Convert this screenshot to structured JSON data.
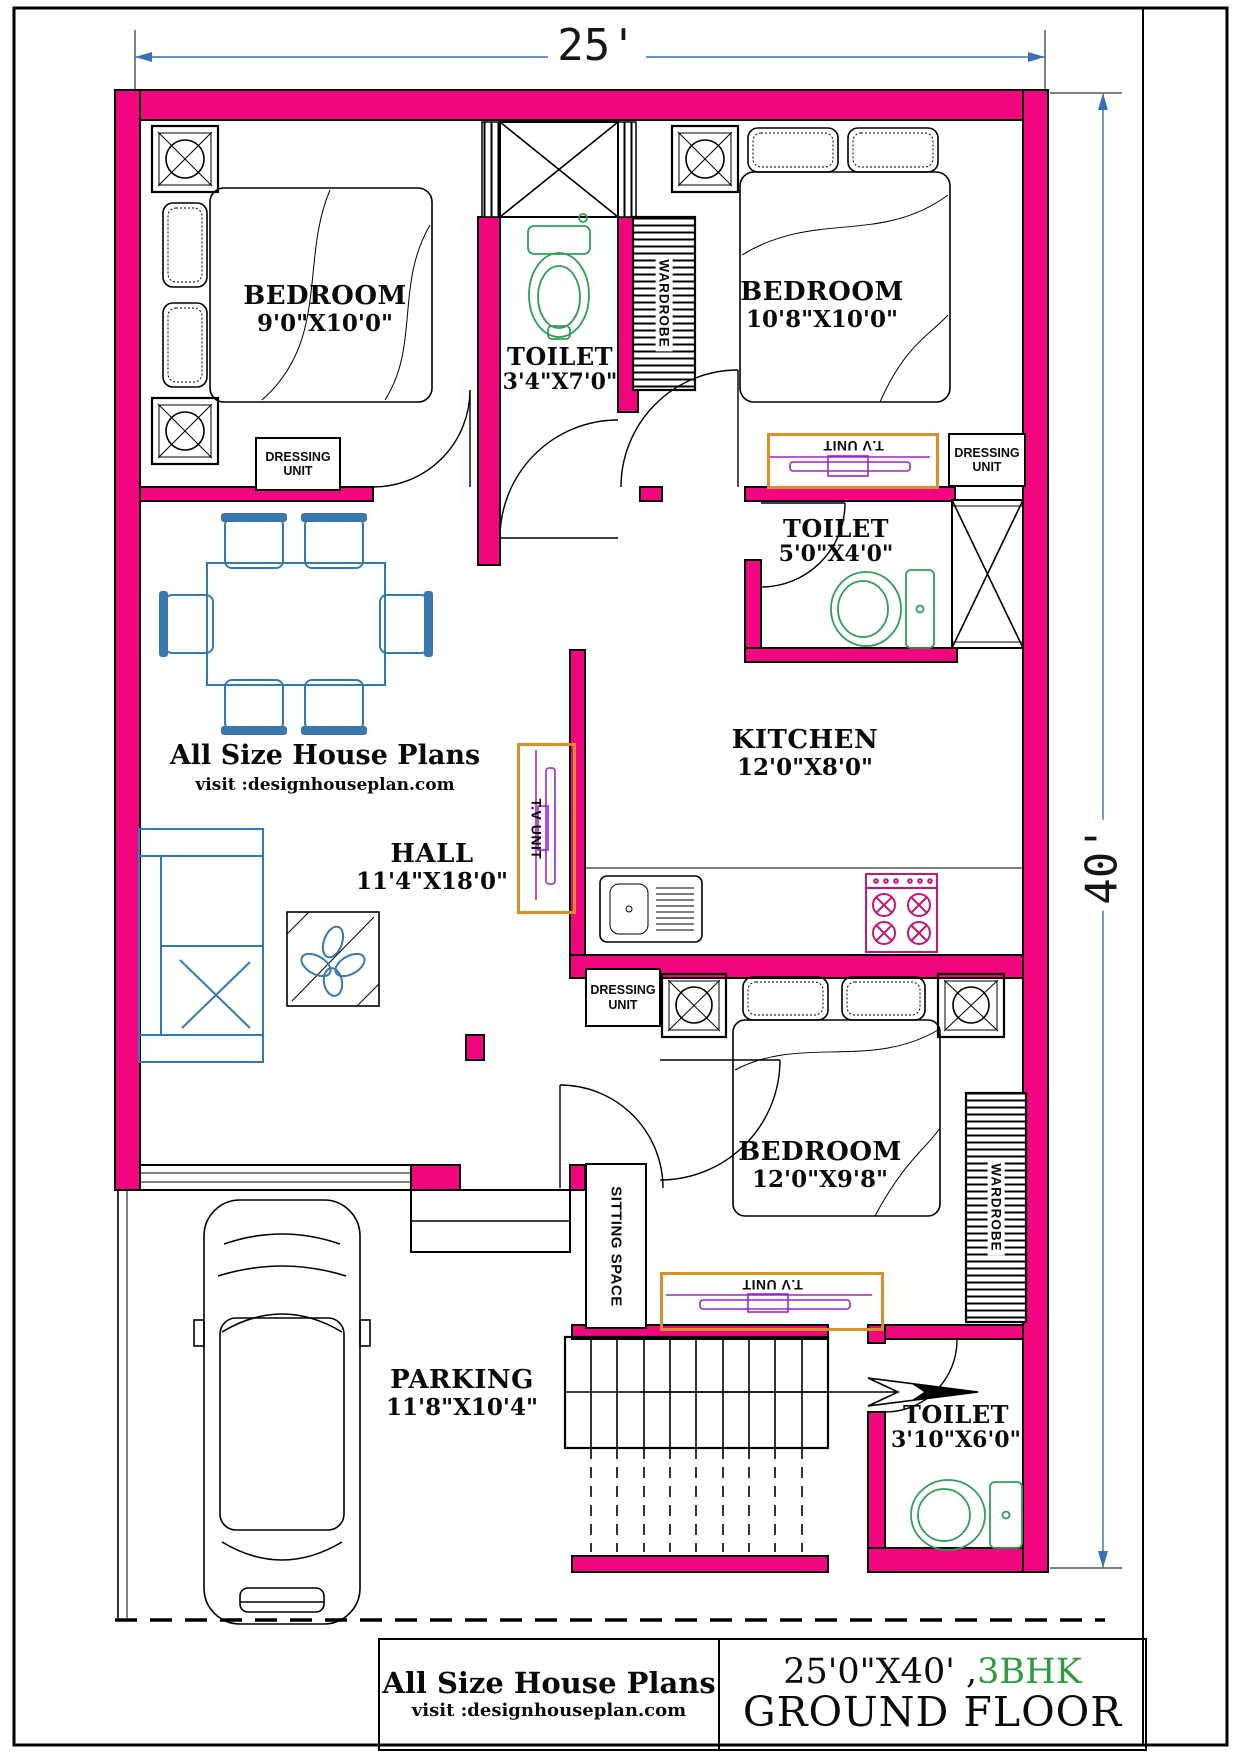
{
  "dimensions": {
    "width_label": "25'",
    "height_label": "40'"
  },
  "rooms": [
    {
      "id": "bedroom-top-left",
      "name": "BEDROOM",
      "size": "9'0\"X10'0\""
    },
    {
      "id": "toilet-top",
      "name": "TOILET",
      "size": "3'4\"X7'0\""
    },
    {
      "id": "bedroom-top-right",
      "name": "BEDROOM",
      "size": "10'8\"X10'0\""
    },
    {
      "id": "toilet-mid",
      "name": "TOILET",
      "size": "5'0\"X4'0\""
    },
    {
      "id": "kitchen",
      "name": "KITCHEN",
      "size": "12'0\"X8'0\""
    },
    {
      "id": "hall",
      "name": "HALL",
      "size": "11'4\"X18'0\""
    },
    {
      "id": "bedroom-bottom",
      "name": "BEDROOM",
      "size": "12'0\"X9'8\""
    },
    {
      "id": "toilet-bottom",
      "name": "TOILET",
      "size": "3'10\"X6'0\""
    },
    {
      "id": "parking",
      "name": "PARKING",
      "size": "11'8\"X10'4\""
    }
  ],
  "labels": {
    "dressing_unit": "DRESSING UNIT",
    "tv_unit": "T.V UNIT",
    "wardrobe": "WARDROBE",
    "sitting_space": "SITTING SPACE"
  },
  "watermark": {
    "line1": "All Size House Plans",
    "line2": "visit :designhouseplan.com"
  },
  "title_block": {
    "brand": "All Size House Plans",
    "website": "visit :designhouseplan.com",
    "plot_size": "25'0\"X40' ,",
    "config": "3BHK",
    "floor": "GROUND FLOOR"
  },
  "colors": {
    "wall": "#F2067F",
    "accent": "#D8902B",
    "tv": "#9B27C9",
    "fix": "#2F9E57",
    "furn": "#3778AE",
    "stove": "#C2187A",
    "dim": "#3B6FB5",
    "bhk": "#2E9B3E"
  }
}
